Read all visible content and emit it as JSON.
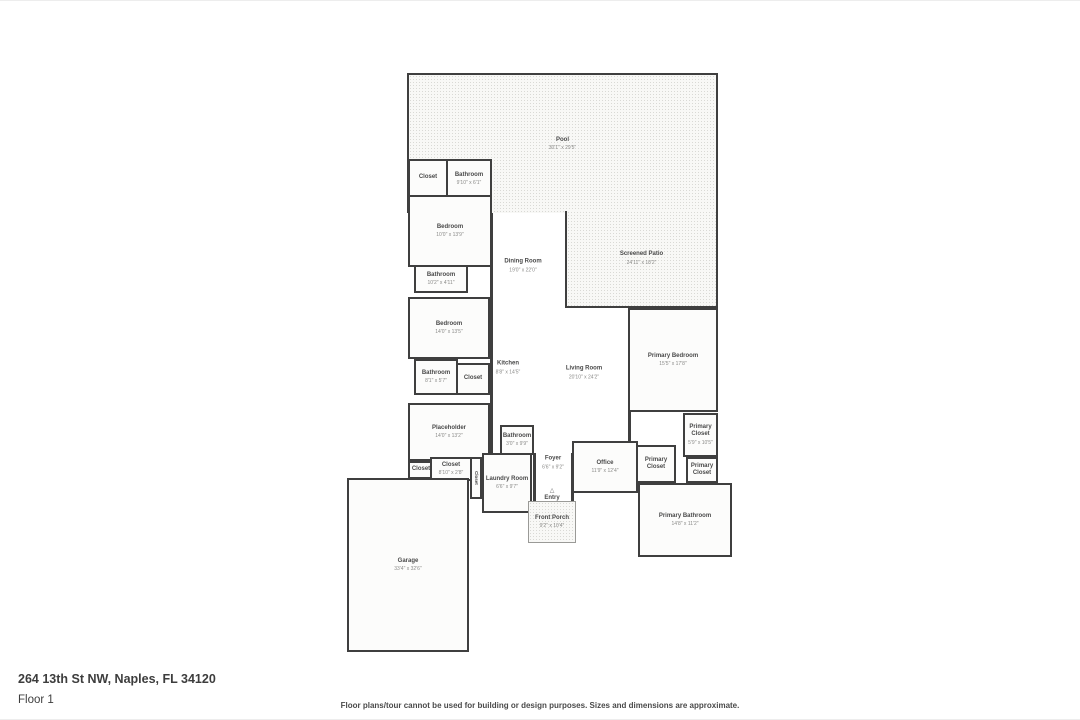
{
  "page": {
    "address": "264 13th St NW, Naples, FL 34120",
    "floor_label": "Floor 1",
    "disclaimer": "Floor plans/tour cannot be used for building or design purposes. Sizes and dimensions are approximate."
  },
  "colors": {
    "wall": "#3f3f3f",
    "room_fill": "#fcfcfb",
    "texture_fill": "#f8f8f6",
    "label_text": "#4a4a4a",
    "dims_text": "#8a8a88"
  },
  "rooms": [
    {
      "id": "pool",
      "name": "Pool",
      "dims": "30'1\" x 29'5\"",
      "style": "textured",
      "x": 407,
      "y": 72,
      "w": 311,
      "h": 140,
      "open_sides": [
        "bottom"
      ]
    },
    {
      "id": "screened-patio",
      "name": "Screened Patio",
      "dims": "24'11\" x 18'2\"",
      "style": "textured",
      "x": 565,
      "y": 210,
      "w": 153,
      "h": 97,
      "open_sides": [
        "top"
      ]
    },
    {
      "id": "closet-top",
      "name": "Closet",
      "dims": null,
      "style": "walled",
      "x": 408,
      "y": 158,
      "w": 40,
      "h": 38
    },
    {
      "id": "bathroom-top",
      "name": "Bathroom",
      "dims": "9'10\" x 6'1\"",
      "style": "walled",
      "x": 446,
      "y": 158,
      "w": 46,
      "h": 40
    },
    {
      "id": "bedroom-1",
      "name": "Bedroom",
      "dims": "10'0\" x 13'9\"",
      "style": "walled",
      "x": 408,
      "y": 194,
      "w": 84,
      "h": 72
    },
    {
      "id": "bathroom-2",
      "name": "Bathroom",
      "dims": "10'2\" x 4'11\"",
      "style": "walled",
      "x": 414,
      "y": 264,
      "w": 54,
      "h": 28
    },
    {
      "id": "bedroom-2",
      "name": "Bedroom",
      "dims": "14'0\" x 13'5\"",
      "style": "walled",
      "x": 408,
      "y": 296,
      "w": 82,
      "h": 62
    },
    {
      "id": "bathroom-3",
      "name": "Bathroom",
      "dims": "8'1\" x 5'7\"",
      "style": "walled",
      "x": 414,
      "y": 358,
      "w": 44,
      "h": 36
    },
    {
      "id": "closet-2",
      "name": "Closet",
      "dims": null,
      "style": "walled",
      "x": 456,
      "y": 362,
      "w": 34,
      "h": 32
    },
    {
      "id": "primary-bedroom",
      "name": "Primary Bedroom",
      "dims": "15'5\" x 17'8\"",
      "style": "walled",
      "x": 628,
      "y": 307,
      "w": 90,
      "h": 104
    },
    {
      "id": "placeholder",
      "name": "Placeholder",
      "dims": "14'0\" x 13'2\"",
      "style": "walled",
      "x": 408,
      "y": 402,
      "w": 82,
      "h": 58
    },
    {
      "id": "bathroom-4",
      "name": "Bathroom",
      "dims": "3'0\" x 9'9\"",
      "style": "walled",
      "x": 500,
      "y": 424,
      "w": 34,
      "h": 30
    },
    {
      "id": "office",
      "name": "Office",
      "dims": "11'9\" x 12'4\"",
      "style": "walled",
      "x": 572,
      "y": 440,
      "w": 66,
      "h": 52
    },
    {
      "id": "primary-closet-1",
      "name": "Primary Closet",
      "dims": "5'9\" x 10'5\"",
      "style": "walled",
      "x": 683,
      "y": 412,
      "w": 35,
      "h": 44
    },
    {
      "id": "primary-closet-2",
      "name": "Primary Closet",
      "dims": null,
      "style": "walled",
      "x": 636,
      "y": 444,
      "w": 40,
      "h": 38
    },
    {
      "id": "primary-closet-3",
      "name": "Primary Closet",
      "dims": null,
      "style": "walled",
      "x": 686,
      "y": 456,
      "w": 32,
      "h": 26
    },
    {
      "id": "closet-3",
      "name": "Closet",
      "dims": null,
      "style": "walled",
      "x": 408,
      "y": 460,
      "w": 26,
      "h": 18
    },
    {
      "id": "closet-4",
      "name": "Closet",
      "dims": "8'10\" x 2'8\"",
      "style": "walled",
      "x": 430,
      "y": 456,
      "w": 42,
      "h": 24
    },
    {
      "id": "closet-5",
      "name": "Closet",
      "dims": null,
      "style": "walled vertical",
      "x": 470,
      "y": 456,
      "w": 12,
      "h": 42
    },
    {
      "id": "laundry-room",
      "name": "Laundry Room",
      "dims": "6'6\" x 9'7\"",
      "style": "walled",
      "x": 482,
      "y": 452,
      "w": 50,
      "h": 60
    },
    {
      "id": "primary-bathroom",
      "name": "Primary Bathroom",
      "dims": "14'8\" x 11'2\"",
      "style": "walled",
      "x": 638,
      "y": 482,
      "w": 94,
      "h": 74
    },
    {
      "id": "garage",
      "name": "Garage",
      "dims": "33'4\" x 32'6\"",
      "style": "walled",
      "x": 347,
      "y": 477,
      "w": 122,
      "h": 174
    },
    {
      "id": "front-porch",
      "name": "Front Porch",
      "dims": "9'2\" x 10'4\"",
      "style": "textured porch",
      "x": 528,
      "y": 500,
      "w": 48,
      "h": 42
    },
    {
      "id": "dining-room",
      "name": "Dining Room",
      "dims": "19'0\" x 22'0\"",
      "style": "open",
      "x": 523,
      "y": 265
    },
    {
      "id": "kitchen",
      "name": "Kitchen",
      "dims": "8'8\" x 14'5\"",
      "style": "open",
      "x": 508,
      "y": 367
    },
    {
      "id": "living-room",
      "name": "Living Room",
      "dims": "20'10\" x 24'2\"",
      "style": "open",
      "x": 584,
      "y": 372
    },
    {
      "id": "foyer",
      "name": "Foyer",
      "dims": "6'6\" x 9'2\"",
      "style": "open",
      "x": 553,
      "y": 462
    },
    {
      "id": "entry",
      "name": "Entry",
      "dims": null,
      "style": "open",
      "x": 552,
      "y": 494,
      "arrow": true
    }
  ],
  "walls": [
    {
      "x": 490,
      "y": 196,
      "w": 3,
      "h": 260
    },
    {
      "x": 490,
      "y": 208,
      "w": 157,
      "h": 3
    },
    {
      "x": 565,
      "y": 210,
      "w": 3,
      "h": 97
    },
    {
      "x": 565,
      "y": 304,
      "w": 153,
      "h": 3
    },
    {
      "x": 628,
      "y": 307,
      "w": 3,
      "h": 135
    },
    {
      "x": 533,
      "y": 452,
      "w": 3,
      "h": 50
    },
    {
      "x": 571,
      "y": 452,
      "w": 3,
      "h": 50
    },
    {
      "x": 407,
      "y": 156,
      "w": 85,
      "h": 3
    }
  ],
  "icons": {
    "entry_arrow": "△"
  }
}
